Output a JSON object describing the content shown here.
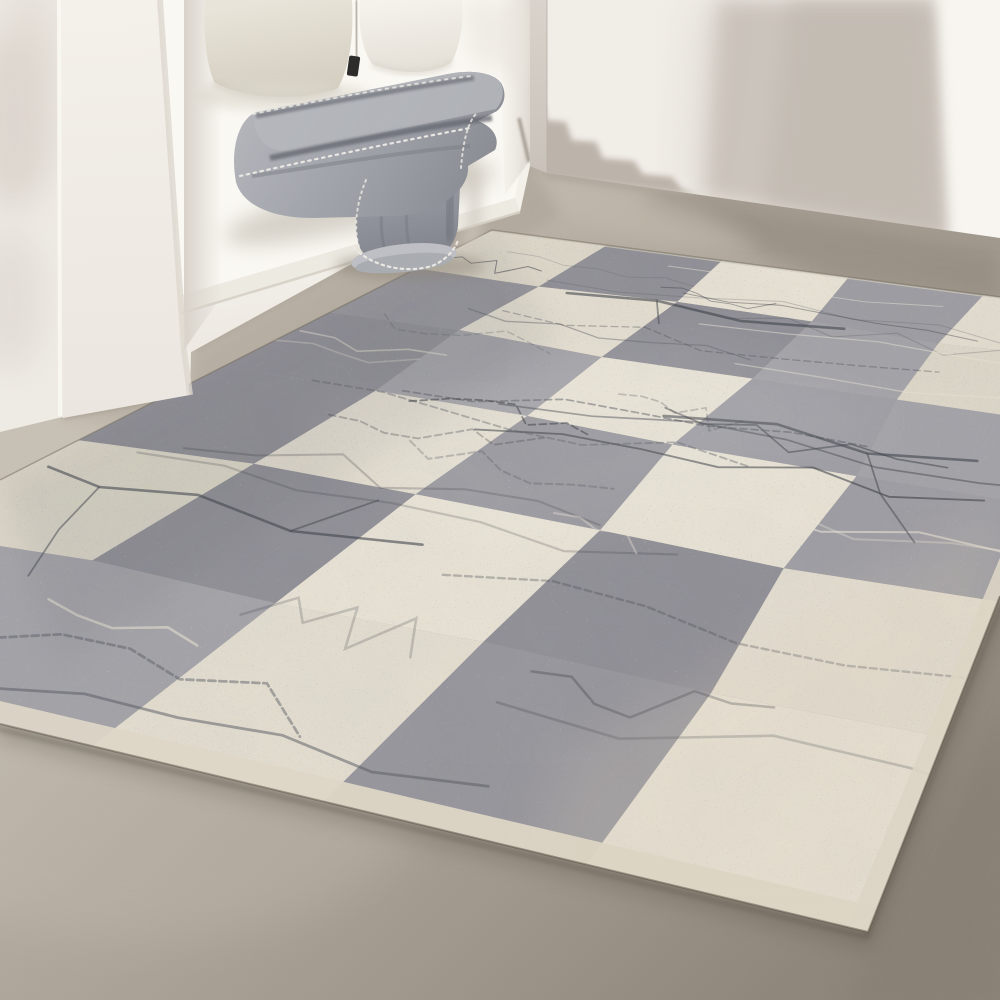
{
  "scene": {
    "alt": "Sunlit minimalist interior: white built-in bench nook with linen pillows, a folded grey wool throw blanket with whip-stitch edging draped over the bench edge, a smooth taupe concrete floor, and a large distressed grey and cream checkerboard area rug",
    "label": "room-product-photo"
  },
  "palette": {
    "wall": "#f1ede7",
    "wall_bright": "#f8f5f1",
    "wall_shadow": "#c7c0b8",
    "wall_shadow_core": "#beb7ae",
    "left_wall": "#eeeae4",
    "return_wall": "#d5cfc8",
    "bench": "#f2efe9",
    "cushion": "#faf8f3",
    "pillow_linen": "#dfd9cd",
    "pillow_white": "#f2efe9",
    "pillow_tag": "#2d2c2b",
    "blanket_light": "#b7b9be",
    "blanket_mid": "#9b9ea5",
    "blanket_dark": "#7e8189",
    "stitch": "#eceae5",
    "floor_light": "#c8c1b5",
    "floor_mid": "#a89f93",
    "floor_dark": "#8e857a",
    "rug_gray": "#98979d",
    "rug_cream": "#e2dcce",
    "rug_scratch": "#474a52",
    "rug_selvedge": "#ddd6c6"
  },
  "rug": {
    "cols": 5,
    "rows": 6,
    "quad": {
      "far": [
        492,
        230
      ],
      "right": [
        1111.7,
        311.8
      ],
      "near": [
        868,
        932
      ],
      "left": [
        -326.4,
        645.8
      ]
    },
    "tone_map": [
      [
        "cream",
        "gray",
        "cream",
        "gray",
        "cream"
      ],
      [
        "gray",
        "cream",
        "gray",
        "gray",
        "cream"
      ],
      [
        "gray",
        "gray",
        "cream",
        "gray",
        "gray"
      ],
      [
        "gray",
        "cream",
        "gray",
        "cream",
        "gray"
      ],
      [
        "cream",
        "gray",
        "cream",
        "gray",
        "cream"
      ],
      [
        "gray",
        "gray",
        "cream",
        "gray",
        "cream"
      ]
    ],
    "gray_variants": [
      "#8f8e95",
      "#96959b",
      "#9d9ca2",
      "#a3a2a7"
    ],
    "cream_variants": [
      "#ddd7c8",
      "#e3ddcf",
      "#e8e2d4",
      "#d9d3c5"
    ],
    "seed": 7,
    "scratches": 26,
    "light_scratches": 9,
    "jitter": {
      "u": 0.01,
      "v": 0.008
    },
    "scratch_colors": [
      "#474a52",
      "#5a5d65",
      "#3c3f47"
    ],
    "light_scratch_color": "#e7e1d2",
    "branch_cracks": [
      {
        "main": [
          [
            0.02,
            0.72
          ],
          [
            0.1,
            0.735
          ],
          [
            0.2,
            0.72
          ],
          [
            0.33,
            0.745
          ],
          [
            0.46,
            0.73
          ]
        ],
        "forks": [
          [
            [
              0.1,
              0.735
            ],
            [
              0.13,
              0.8
            ],
            [
              0.17,
              0.86
            ]
          ],
          [
            [
              0.33,
              0.745
            ],
            [
              0.37,
              0.68
            ]
          ]
        ]
      },
      {
        "main": [
          [
            0.25,
            0.18
          ],
          [
            0.38,
            0.165
          ],
          [
            0.52,
            0.19
          ],
          [
            0.66,
            0.17
          ]
        ],
        "forks": [
          [
            [
              0.38,
              0.165
            ],
            [
              0.42,
              0.23
            ]
          ]
        ]
      },
      {
        "main": [
          [
            0.55,
            0.45
          ],
          [
            0.68,
            0.43
          ],
          [
            0.8,
            0.46
          ],
          [
            0.92,
            0.44
          ]
        ],
        "forks": [
          [
            [
              0.8,
              0.46
            ],
            [
              0.84,
              0.53
            ],
            [
              0.9,
              0.6
            ]
          ]
        ]
      }
    ],
    "selvedge": {
      "front": 0.018,
      "right": 0.014,
      "far": 0.007,
      "color": "#ddd6c6",
      "far_color": "#cfc9bb"
    }
  }
}
